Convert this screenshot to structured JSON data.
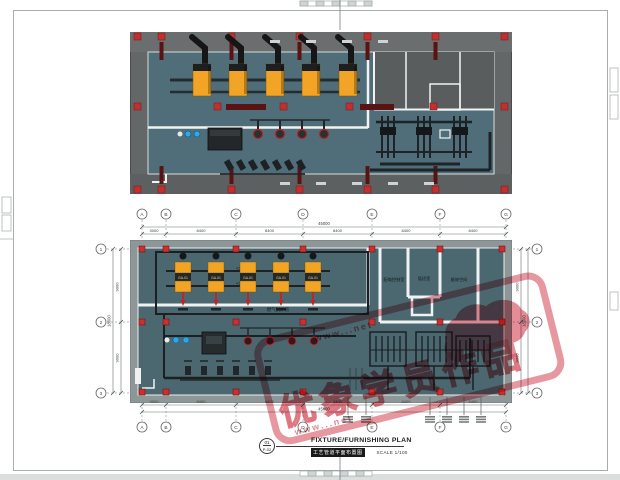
{
  "plan": {
    "grid_cols": [
      "A",
      "B",
      "C",
      "D",
      "E",
      "F",
      "G"
    ],
    "grid_rows": [
      "1",
      "2",
      "3"
    ],
    "dims": {
      "h_segments": [
        "3000",
        "8400",
        "8400",
        "8400",
        "8400",
        "8400"
      ],
      "h_total": "45000",
      "v_segments": [
        "9000",
        "9000"
      ],
      "v_total": "18000"
    },
    "boiler_tag": "GA-01",
    "boiler_count": 5,
    "rooms": [
      "配电控制室",
      "值班室",
      "维修空间"
    ],
    "hall_label": "燃气锅炉房",
    "pipe_elevation": "4.550"
  },
  "title_block": {
    "detail_no": "01",
    "sheet_no": "P-02",
    "title_en": "FIXTURE/FURNISHING PLAN",
    "title_cn": "工艺管道平面布置图",
    "scale_label": "SCALE 1/100"
  },
  "watermark": {
    "main_text": "优象学员作品",
    "url_text": "www...net",
    "color": "#e07d87"
  },
  "colors": {
    "floor_teal_3d": "#4f6e79",
    "floor_teal_plan": "#4b6871",
    "wall_gray_3d": "#646767",
    "band_gray_plan": "#8e9797",
    "boiler_orange": "#f2a425",
    "column_red": "#d22c2c",
    "beam_dark_red": "#5a1313",
    "pipe_black": "#1d2124",
    "pump_blue": "#2aa7e8",
    "stamp_pink": "#e07d87"
  }
}
